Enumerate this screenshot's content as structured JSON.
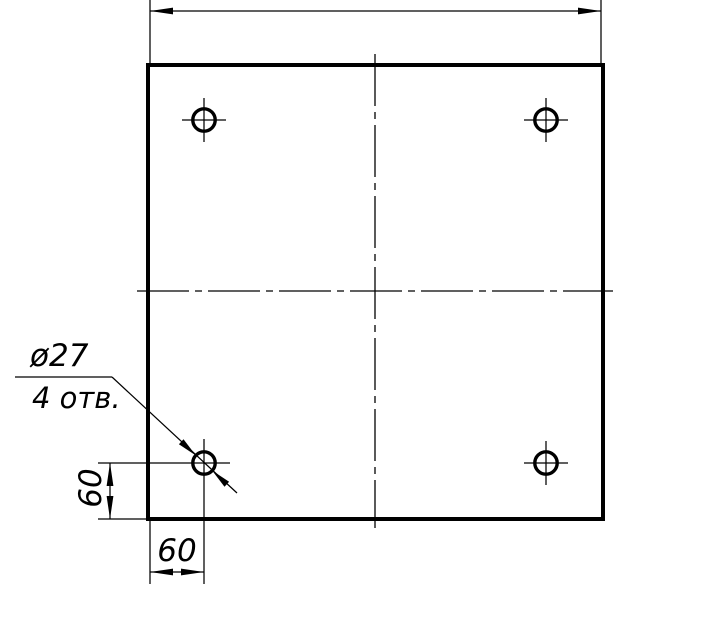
{
  "drawing": {
    "type": "engineering_drawing",
    "subject": "Square plate with 4 mounting holes",
    "background_color": "#ffffff",
    "line_color": "#000000",
    "hole_callout": {
      "diameter_label": "ø27",
      "count_label": "4 отв."
    },
    "dimensions": {
      "hole_offset_vertical": "60",
      "hole_offset_horizontal": "60"
    }
  }
}
